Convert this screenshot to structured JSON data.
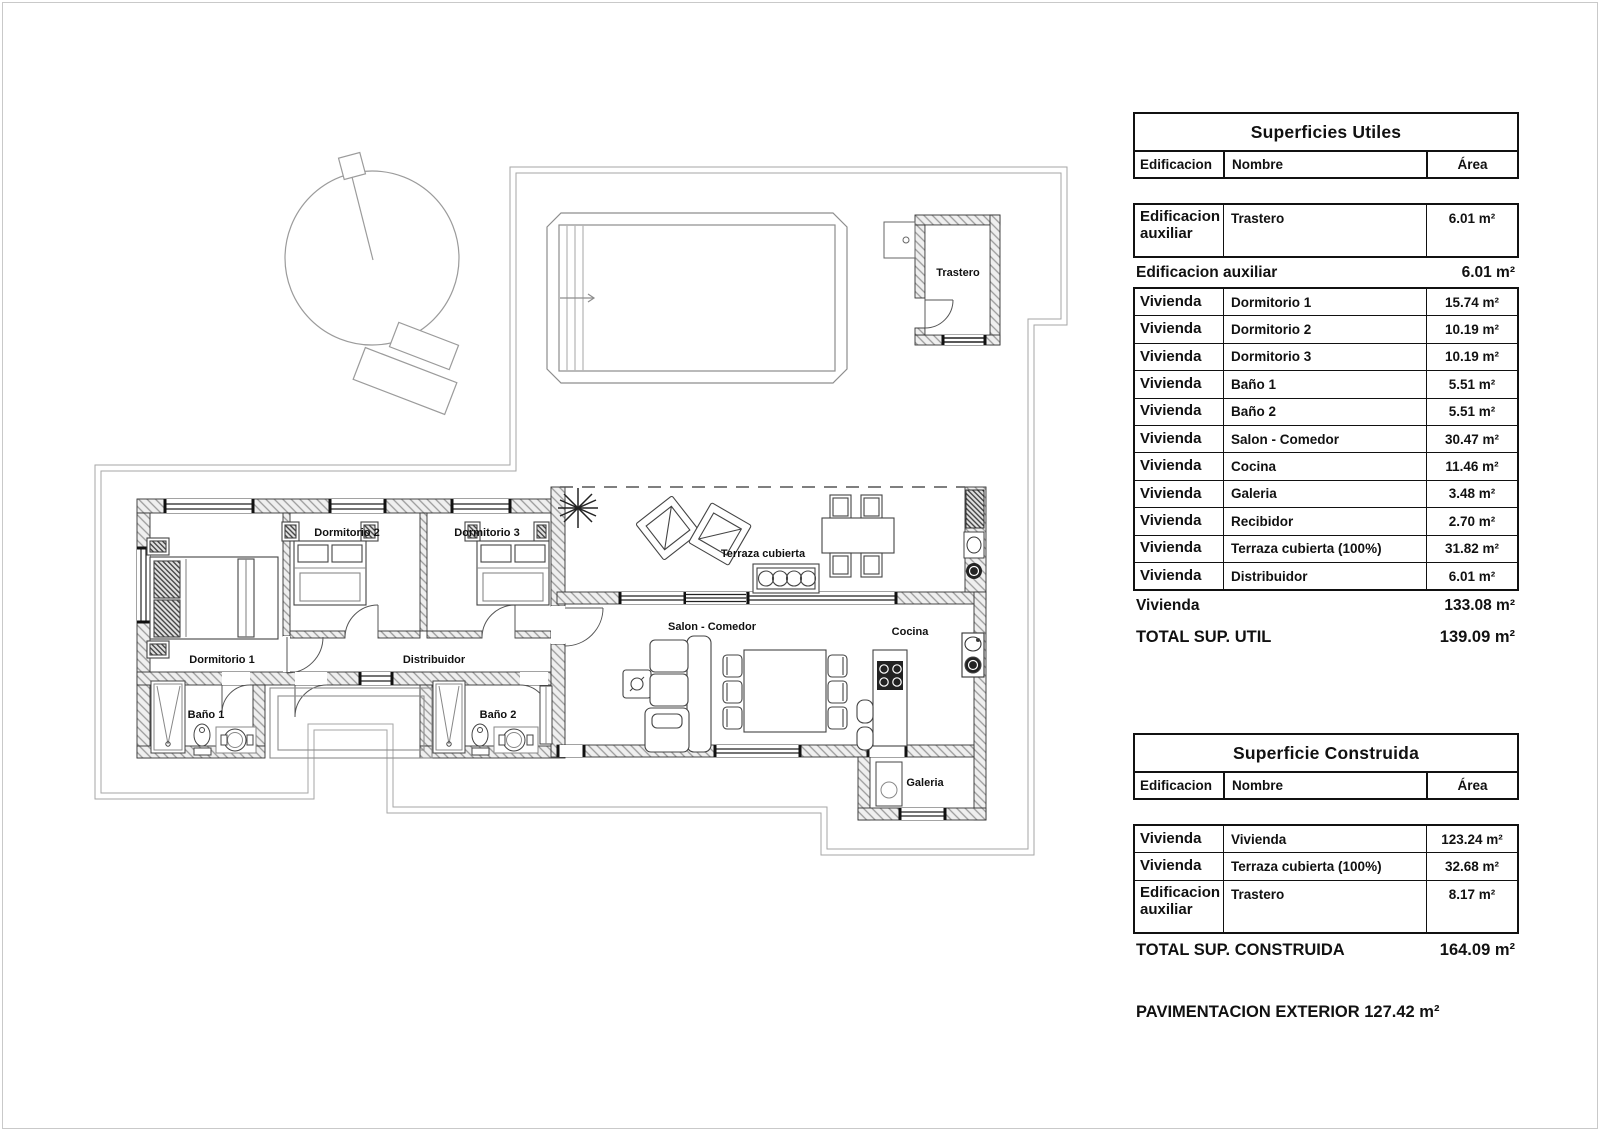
{
  "plan": {
    "labels": [
      {
        "id": "trastero",
        "text": "Trastero",
        "x": 958,
        "y": 276
      },
      {
        "id": "dormitorio-2",
        "text": "Dormitorio 2",
        "x": 347,
        "y": 536
      },
      {
        "id": "dormitorio-3",
        "text": "Dormitorio 3",
        "x": 487,
        "y": 536
      },
      {
        "id": "terraza-cubierta",
        "text": "Terraza cubierta",
        "x": 763,
        "y": 557
      },
      {
        "id": "dormitorio-1",
        "text": "Dormitorio 1",
        "x": 222,
        "y": 663
      },
      {
        "id": "distribuidor",
        "text": "Distribuidor",
        "x": 434,
        "y": 663
      },
      {
        "id": "salon-comedor",
        "text": "Salon - Comedor",
        "x": 712,
        "y": 630
      },
      {
        "id": "cocina",
        "text": "Cocina",
        "x": 910,
        "y": 635
      },
      {
        "id": "bano-1",
        "text": "Baño 1",
        "x": 206,
        "y": 718
      },
      {
        "id": "bano-2",
        "text": "Baño 2",
        "x": 498,
        "y": 718
      },
      {
        "id": "galeria",
        "text": "Galeria",
        "x": 925,
        "y": 786
      }
    ]
  },
  "tables": [
    {
      "id": "superficies-utiles",
      "title": "Superficies Utiles",
      "columns": [
        "Edificacion",
        "Nombre",
        "Área"
      ],
      "sections": [
        {
          "type": "rows",
          "gap": true,
          "rows": [
            {
              "edificacion": "Edificacion auxiliar",
              "nombre": "Trastero",
              "area": "6.01 m²",
              "tall": true
            }
          ]
        },
        {
          "type": "summary",
          "label": "Edificacion auxiliar",
          "value": "6.01 m²"
        },
        {
          "type": "rows",
          "rows": [
            {
              "edificacion": "Vivienda",
              "nombre": "Dormitorio 1",
              "area": "15.74 m²"
            },
            {
              "edificacion": "Vivienda",
              "nombre": "Dormitorio 2",
              "area": "10.19 m²"
            },
            {
              "edificacion": "Vivienda",
              "nombre": "Dormitorio 3",
              "area": "10.19 m²"
            },
            {
              "edificacion": "Vivienda",
              "nombre": "Baño 1",
              "area": "5.51 m²"
            },
            {
              "edificacion": "Vivienda",
              "nombre": "Baño 2",
              "area": "5.51 m²"
            },
            {
              "edificacion": "Vivienda",
              "nombre": "Salon - Comedor",
              "area": "30.47 m²"
            },
            {
              "edificacion": "Vivienda",
              "nombre": "Cocina",
              "area": "11.46 m²"
            },
            {
              "edificacion": "Vivienda",
              "nombre": "Galeria",
              "area": "3.48 m²"
            },
            {
              "edificacion": "Vivienda",
              "nombre": "Recibidor",
              "area": "2.70 m²"
            },
            {
              "edificacion": "Vivienda",
              "nombre": "Terraza cubierta (100%)",
              "area": "31.82 m²"
            },
            {
              "edificacion": "Vivienda",
              "nombre": "Distribuidor",
              "area": "6.01 m²"
            }
          ]
        },
        {
          "type": "summary",
          "label": "Vivienda",
          "value": "133.08 m²"
        },
        {
          "type": "summary",
          "label": "TOTAL SUP. UTIL",
          "value": "139.09 m²",
          "emphasis": true
        }
      ]
    },
    {
      "id": "superficie-construida",
      "title": "Superficie Construida",
      "columns": [
        "Edificacion",
        "Nombre",
        "Área"
      ],
      "sections": [
        {
          "type": "rows",
          "gap": true,
          "rows": [
            {
              "edificacion": "Vivienda",
              "nombre": "Vivienda",
              "area": "123.24 m²"
            },
            {
              "edificacion": "Vivienda",
              "nombre": "Terraza cubierta (100%)",
              "area": "32.68 m²"
            },
            {
              "edificacion": "Edificacion auxiliar",
              "nombre": "Trastero",
              "area": "8.17 m²",
              "tall": true
            }
          ]
        },
        {
          "type": "summary",
          "label": "TOTAL SUP. CONSTRUIDA",
          "value": "164.09 m²",
          "emphasis": true
        }
      ]
    }
  ],
  "footer": {
    "pavimentacion": "PAVIMENTACION EXTERIOR 127.42 m²"
  }
}
